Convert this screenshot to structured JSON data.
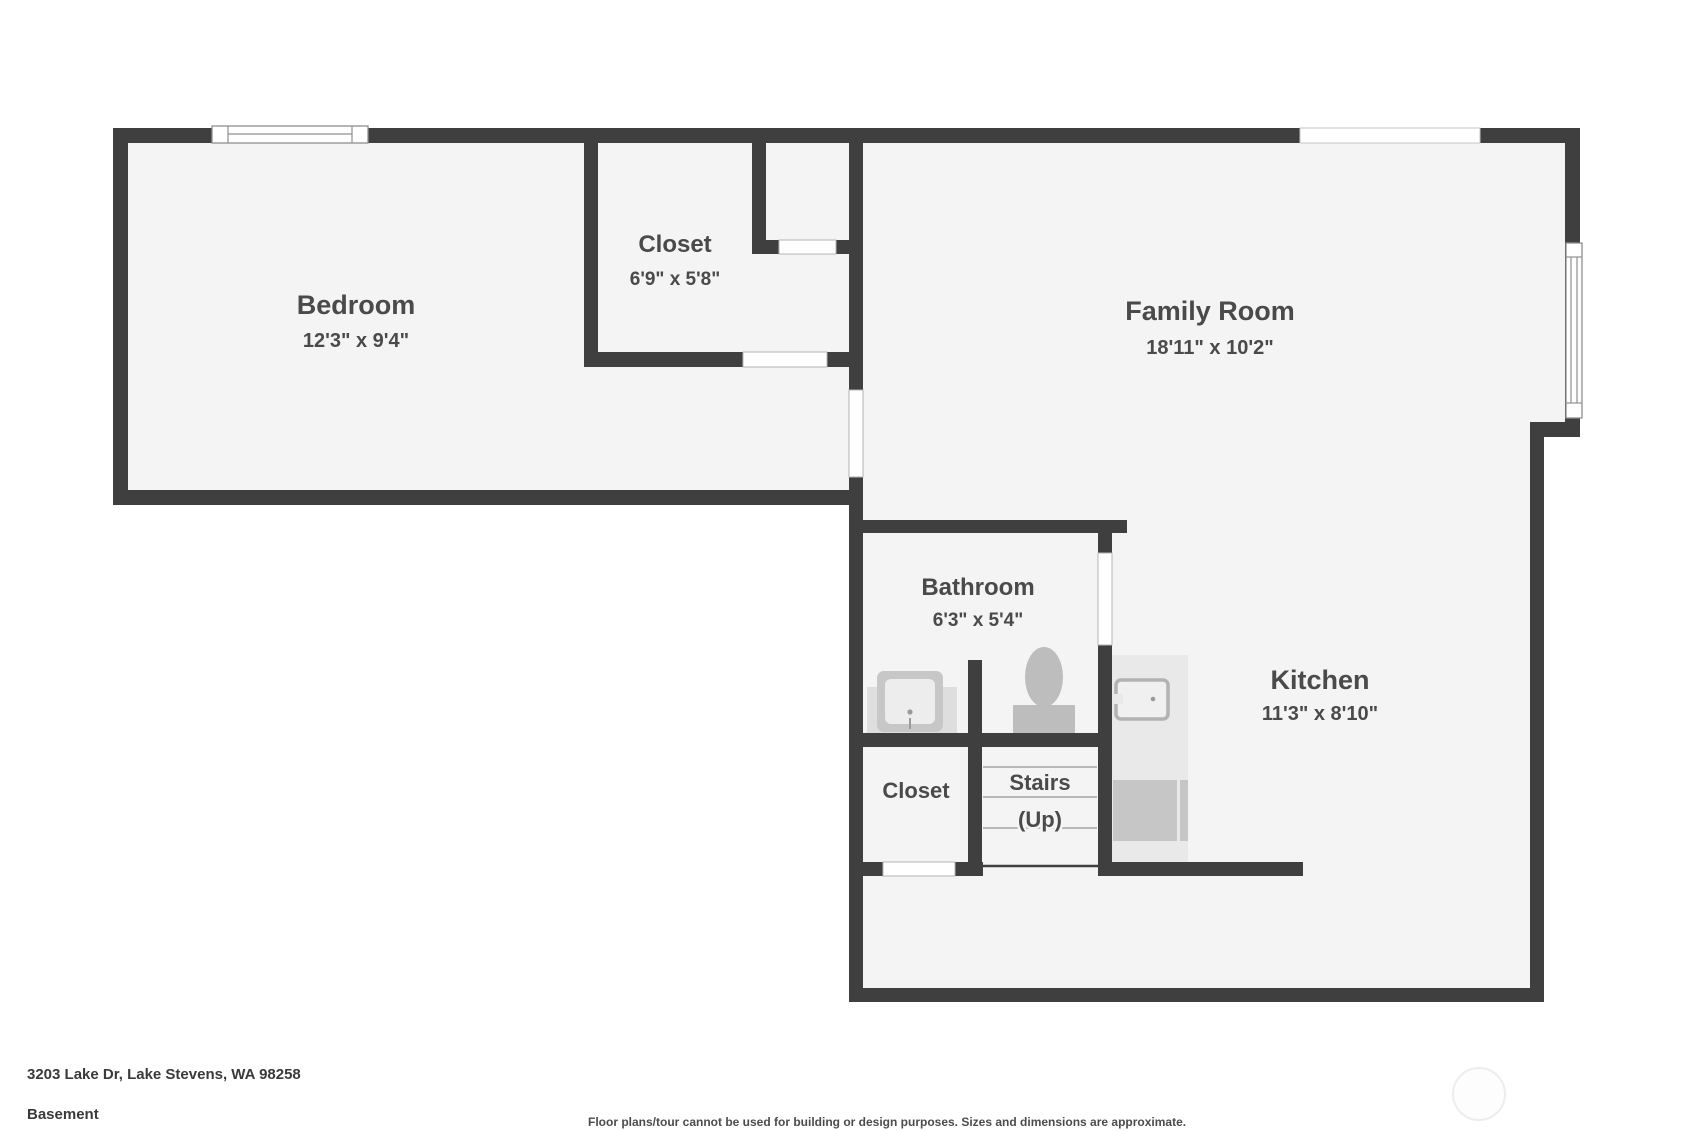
{
  "floor_plan": {
    "level": "Basement",
    "address": "3203 Lake Dr, Lake Stevens, WA 98258",
    "disclaimer": "Floor plans/tour cannot be used for building or design purposes. Sizes and dimensions are approximate.",
    "colors": {
      "wall": "#3f3f3f",
      "floor": "#f4f4f4",
      "door_opening": "#ffffff",
      "window_frame": "#8f8f8f",
      "fixture": "#bdbdbd",
      "counter": "#e9e9e9",
      "label_text": "#4a4a4a"
    },
    "rooms": {
      "bedroom": {
        "name": "Bedroom",
        "dimensions": "12'3\" x 9'4\""
      },
      "closet_upper": {
        "name": "Closet",
        "dimensions": "6'9\" x 5'8\""
      },
      "family_room": {
        "name": "Family Room",
        "dimensions": "18'11\" x 10'2\""
      },
      "bathroom": {
        "name": "Bathroom",
        "dimensions": "6'3\" x 5'4\""
      },
      "kitchen": {
        "name": "Kitchen",
        "dimensions": "11'3\" x 8'10\""
      },
      "closet_lower": {
        "name": "Closet"
      },
      "stairs": {
        "name": "Stairs",
        "direction": "(Up)"
      }
    }
  }
}
